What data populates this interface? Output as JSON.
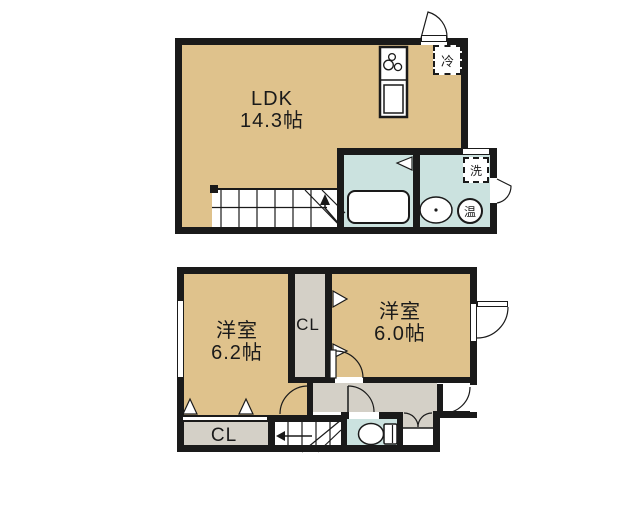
{
  "colors": {
    "wall": "#1a1a1a",
    "room_tan": "#dfc28c",
    "wet_area_blue": "#cbe2df",
    "closet_gray": "#d4d0c7",
    "background": "#ffffff"
  },
  "floor_2f": {
    "ldk": {
      "name": "LDK",
      "area": "14.3帖"
    },
    "fridge_label": "冷",
    "washer_label": "洗",
    "water_heater_label": "温"
  },
  "floor_1f": {
    "bedroom_left": {
      "name": "洋室",
      "area": "6.2帖"
    },
    "bedroom_right": {
      "name": "洋室",
      "area": "6.0帖"
    },
    "closet_middle_label": "CL",
    "closet_bottom_label": "CL"
  },
  "icons": {
    "stove": "stove-burners-icon",
    "kitchen_sink": "kitchen-sink-icon",
    "bathtub": "bathtub-icon",
    "washbasin": "washbasin-icon",
    "toilet": "toilet-icon",
    "stairs_up_arrow": "stairs-up-arrow-icon",
    "stairs_down_arrow": "stairs-down-arrow-icon",
    "door_swing": "door-swing-arc-icon"
  }
}
